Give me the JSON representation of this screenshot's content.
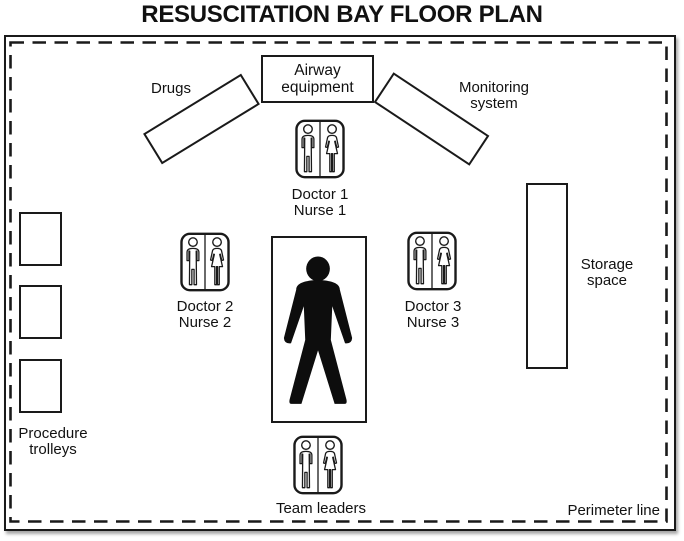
{
  "title": "RESUSCITATION BAY FLOOR PLAN",
  "zones": {
    "drugs_label": "Drugs",
    "airway": {
      "line1": "Airway",
      "line2": "equipment"
    },
    "monitoring": {
      "line1": "Monitoring",
      "line2": "system"
    },
    "storage": {
      "line1": "Storage",
      "line2": "space"
    },
    "procedure_trolleys": {
      "line1": "Procedure",
      "line2": "trolleys"
    },
    "perimeter_label": "Perimeter line"
  },
  "staff": {
    "position1": {
      "line1": "Doctor 1",
      "line2": "Nurse 1"
    },
    "position2": {
      "line1": "Doctor 2",
      "line2": "Nurse 2"
    },
    "position3": {
      "line1": "Doctor 3",
      "line2": "Nurse 3"
    },
    "team_leaders": {
      "label": "Team leaders"
    }
  },
  "icons": {
    "staff_pair": "male-female-pair-icon",
    "patient": "patient-silhouette-icon"
  },
  "colors": {
    "line": "#1a1a1a",
    "background": "#ffffff",
    "silhouette": "#0d0d0d"
  }
}
